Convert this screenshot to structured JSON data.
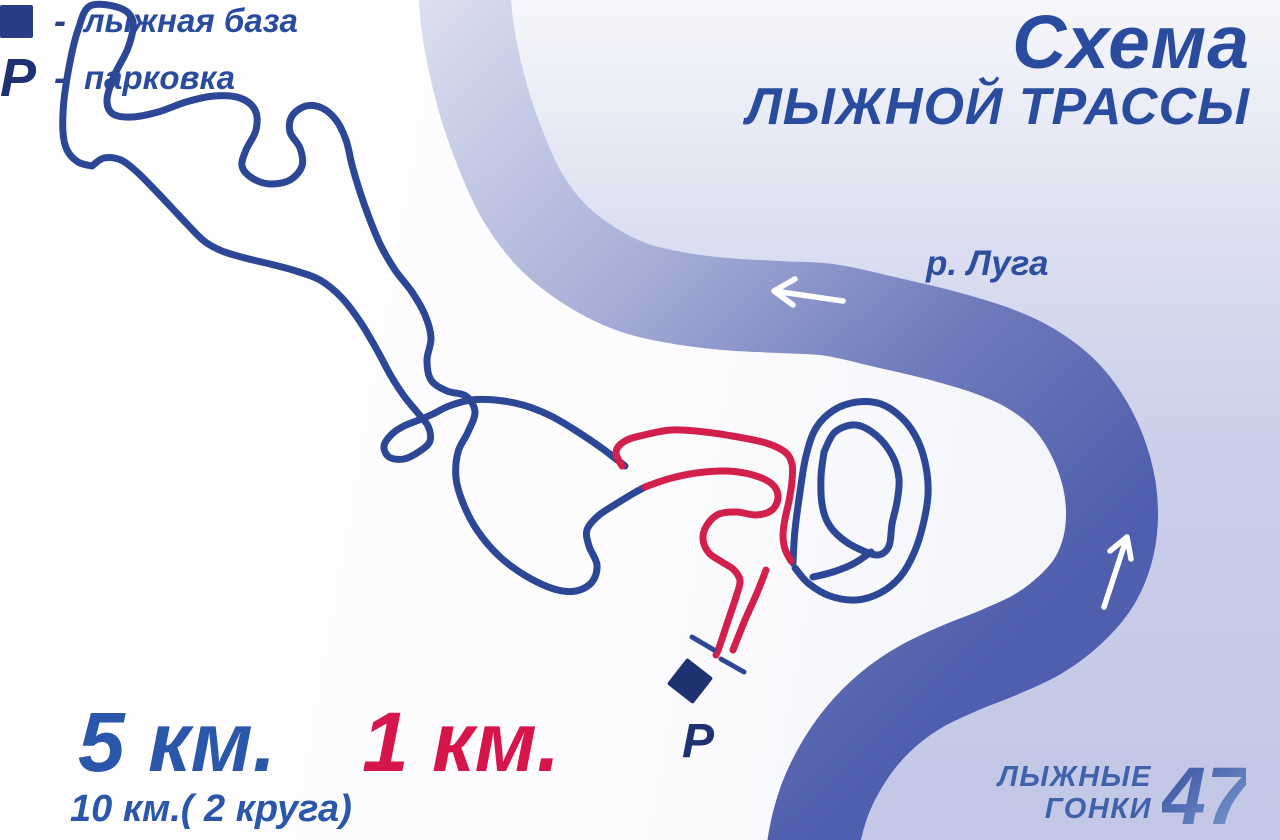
{
  "title": {
    "line1": "Схема",
    "line2": "ЛЫЖНОЙ ТРАССЫ"
  },
  "river": {
    "label": "р. Луга"
  },
  "legend": {
    "separator": "-",
    "items": [
      {
        "icon": "ski-base-square",
        "label": "лыжная база"
      },
      {
        "icon": "parking-letter",
        "symbol": "Р",
        "label": "парковка"
      }
    ]
  },
  "distances": {
    "blue_trail": "5 км.",
    "red_trail": "1 км.",
    "note": "10 км.( 2 круга)"
  },
  "markers": {
    "parking": "Р"
  },
  "logo": {
    "line1": "ЛЫЖНЫЕ",
    "line2": "ГОНКИ",
    "number": "47"
  },
  "trails": [
    {
      "name": "blue-trail",
      "length_label": "5 км.",
      "lap_note": "10 км.( 2 круга)",
      "color": "#2c4795"
    },
    {
      "name": "red-trail",
      "length_label": "1 км.",
      "color": "#d31f4c"
    }
  ],
  "colors": {
    "title_blue": "#294c9e",
    "trail_blue": "#2c4795",
    "trail_red": "#d31f4c",
    "river_dark": "#4f5ead",
    "river_light": "#dfe2f0",
    "bank_lavender": "#c7cce8",
    "marker_navy": "#1e3170",
    "arrow_white": "#ffffff"
  }
}
